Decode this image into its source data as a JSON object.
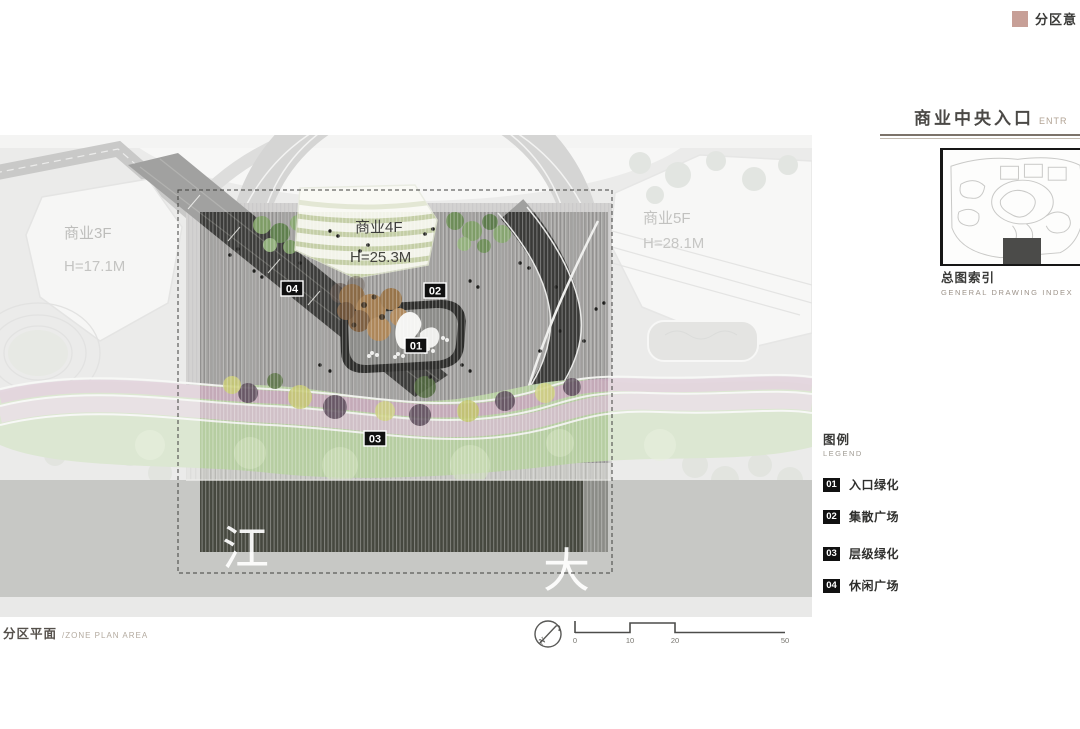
{
  "header": {
    "tag_label": "分区意",
    "tag_color": "#c79f97"
  },
  "section_title": {
    "zh": "商业中央入口",
    "en": "ENTR"
  },
  "drawing_index": {
    "zh": "总图索引",
    "en": "GENERAL DRAWING INDEX"
  },
  "legend": {
    "zh": "图例",
    "en": "LEGEND",
    "items": [
      {
        "num": "01",
        "label": "入口绿化"
      },
      {
        "num": "02",
        "label": "集散广场"
      },
      {
        "num": "03",
        "label": "层级绿化"
      },
      {
        "num": "04",
        "label": "休闲广场"
      }
    ]
  },
  "footer": {
    "zh": "分区平面",
    "en": "/ZONE PLAN AREA"
  },
  "scale_bar": {
    "labels": [
      "0",
      "10",
      "20",
      "50"
    ]
  },
  "compass": {
    "letter": "N"
  },
  "plan": {
    "buildings": [
      {
        "name": "商业3F",
        "height": "H=17.1M"
      },
      {
        "name": "商业4F",
        "height": "H=25.3M"
      },
      {
        "name": "商业5F",
        "height": "H=28.1M"
      }
    ],
    "markers": [
      {
        "num": "01"
      },
      {
        "num": "02"
      },
      {
        "num": "03"
      },
      {
        "num": "04"
      }
    ],
    "road_text": [
      "江",
      "大"
    ]
  }
}
